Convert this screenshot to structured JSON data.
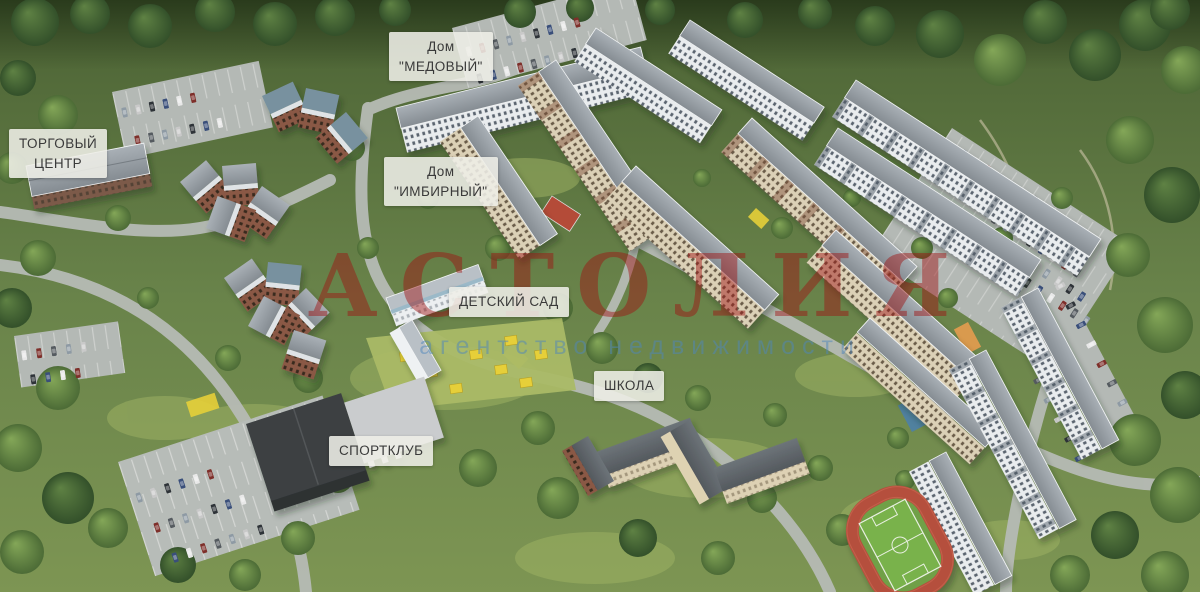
{
  "scene": {
    "type": "aerial-masterplan-render",
    "watermark": {
      "main": "АСТОЛИЯ",
      "sub": "агентство недвижимости",
      "main_color": "#a01212",
      "sub_color": "#4f86bb"
    },
    "labels": [
      {
        "name": "dom-medovy",
        "line1": "Дом",
        "line2": "\"МЕДОВЫЙ\""
      },
      {
        "name": "shopping-center",
        "line1": "ТОРГОВЫЙ",
        "line2": "ЦЕНТР"
      },
      {
        "name": "dom-imbirny",
        "line1": "Дом",
        "line2": "\"ИМБИРНЫЙ\""
      },
      {
        "name": "kindergarten",
        "line1": "ДЕТСКИЙ САД",
        "line2": ""
      },
      {
        "name": "school",
        "line1": "ШКОЛА",
        "line2": ""
      },
      {
        "name": "sport-club",
        "line1": "СПОРТКЛУБ",
        "line2": ""
      }
    ],
    "legend_colors": {
      "forest_green": "#4c6b36",
      "road_gray": "#b6bbb5",
      "track_red": "#b5503c",
      "court_red": "#b44b38",
      "playground_yellow": "#e6cf39"
    }
  }
}
